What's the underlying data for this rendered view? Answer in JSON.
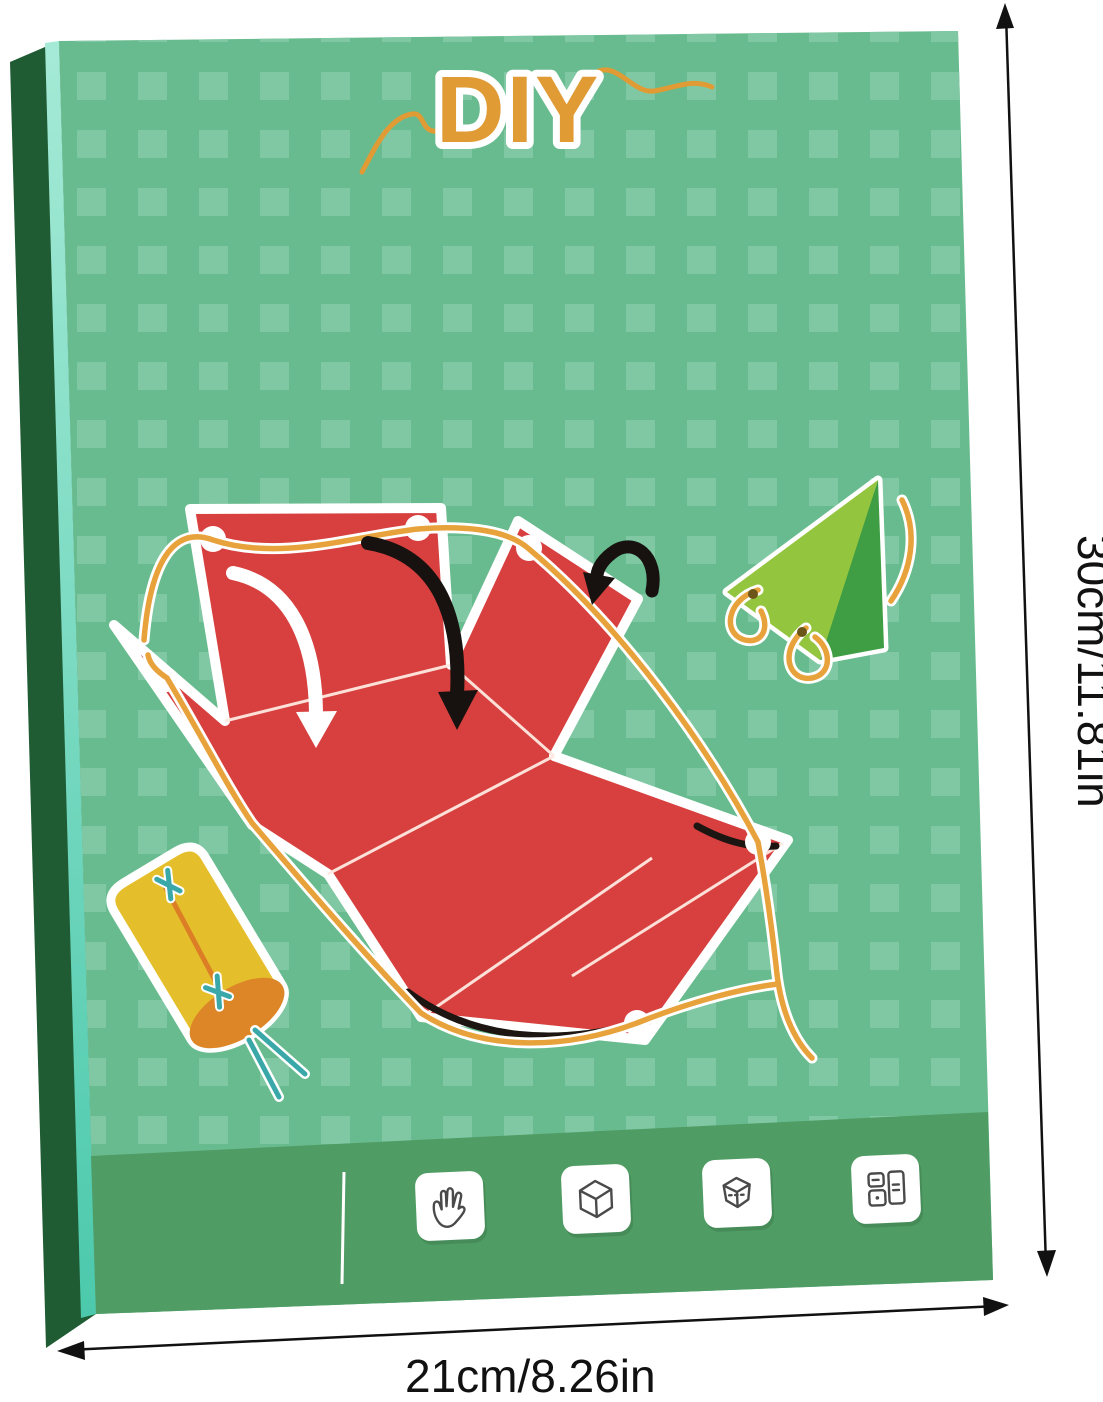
{
  "box": {
    "title": "DIY",
    "footer": {
      "divider": "vertical-white-line",
      "icons": [
        "hand-icon",
        "cube-outline-icon",
        "transparent-cube-icon",
        "split-cards-icon"
      ]
    },
    "illustration_pieces": [
      "red-folding-net-with-orange-string",
      "green-triangle-with-string-loops",
      "yellow-cylinder-with-teal-string"
    ]
  },
  "dimensions": {
    "height_label": "30cm/11.81in",
    "width_label": "21cm/8.26in"
  },
  "colors": {
    "box_face_green": "#68bb8e",
    "box_pattern_square": "#80c8a4",
    "footer_green": "#4f9c64",
    "spine_dark_green": "#1f5c33",
    "spine_teal_strip": "#6fd9c0",
    "title_orange": "#e09b35",
    "string_orange": "#e8a23b",
    "net_red": "#d7403f",
    "triangle_light_green": "#94c53f",
    "triangle_dark_green": "#3f9e43",
    "cylinder_yellow": "#e5bf2b",
    "cylinder_cap_orange": "#dd8627",
    "stitch_teal": "#3aa8a8",
    "dimension_text": "#111111"
  }
}
